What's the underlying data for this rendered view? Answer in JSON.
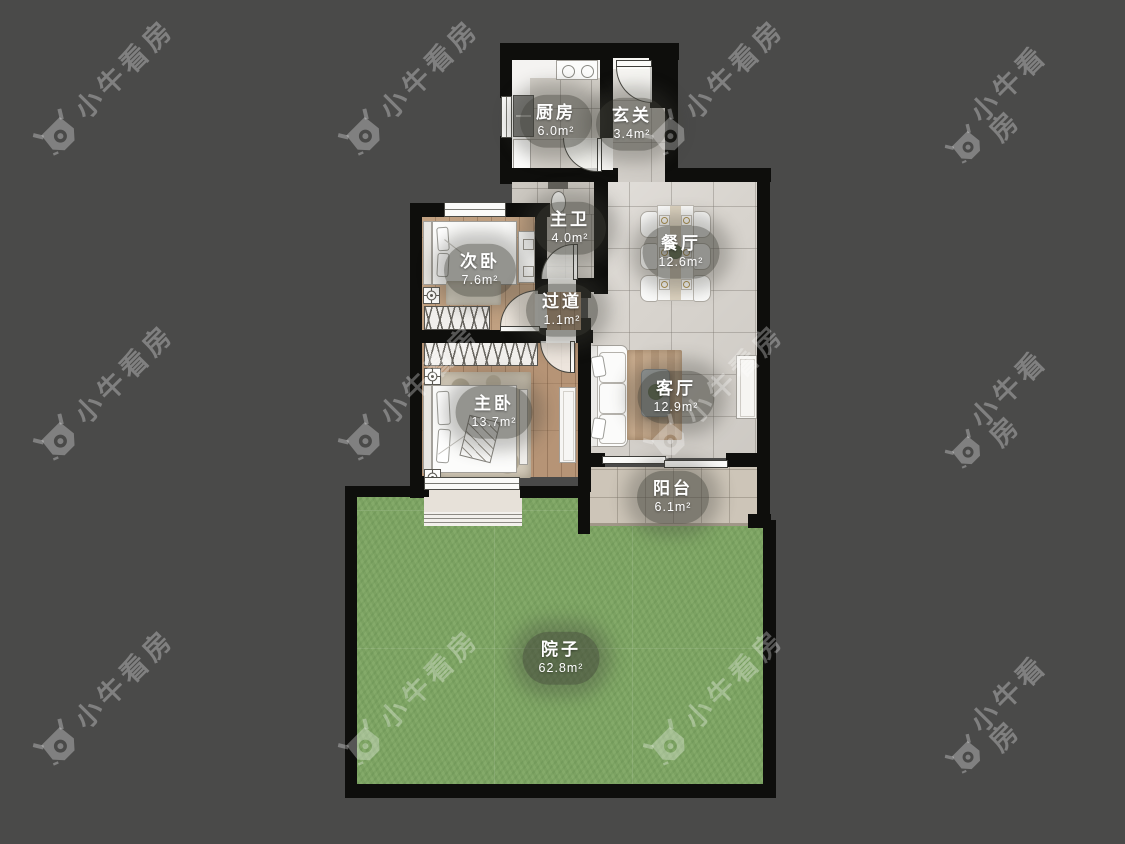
{
  "watermark": {
    "brand": "小牛看房"
  },
  "rooms": [
    {
      "id": "kitchen",
      "name": "厨房",
      "area": "6.0m²"
    },
    {
      "id": "entry",
      "name": "玄关",
      "area": "3.4m²"
    },
    {
      "id": "master-bath",
      "name": "主卫",
      "area": "4.0m²"
    },
    {
      "id": "second-bedroom",
      "name": "次卧",
      "area": "7.6m²"
    },
    {
      "id": "hallway",
      "name": "过道",
      "area": "1.1m²"
    },
    {
      "id": "dining-room",
      "name": "餐厅",
      "area": "12.6m²"
    },
    {
      "id": "living-room",
      "name": "客厅",
      "area": "12.9m²"
    },
    {
      "id": "master-bedroom",
      "name": "主卧",
      "area": "13.7m²"
    },
    {
      "id": "balcony",
      "name": "阳台",
      "area": "6.1m²"
    },
    {
      "id": "yard",
      "name": "院子",
      "area": "62.8m²"
    }
  ],
  "colors": {
    "background": "#4a4a49",
    "wall": "#0e0e0c",
    "grass": "#7da463",
    "tile": "#d8d4ce",
    "wood": "#c0a081",
    "label_bg": "rgba(62,62,55,0.55)",
    "watermark": "rgba(255,255,255,0.30)"
  }
}
